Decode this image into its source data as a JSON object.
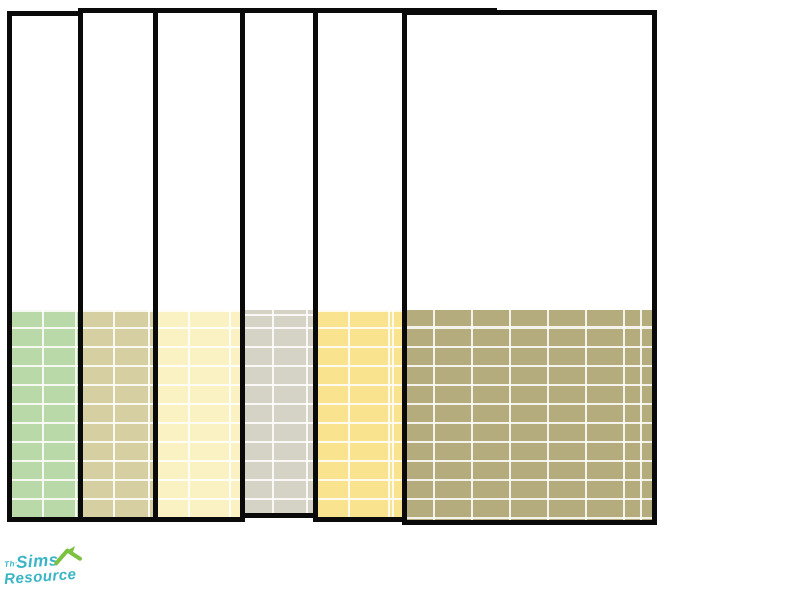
{
  "panels": {
    "border_color": "#0a0a0a",
    "wall_color": "#ffffff",
    "grout_color": "#f5f3e8",
    "items": [
      {
        "id": "swatch-1",
        "color_name": "pastel-green",
        "tile_color": "#b9daa8"
      },
      {
        "id": "swatch-2",
        "color_name": "tan",
        "tile_color": "#d6cfa1"
      },
      {
        "id": "swatch-3",
        "color_name": "cream",
        "tile_color": "#fbf2c4"
      },
      {
        "id": "swatch-4",
        "color_name": "warm-gray",
        "tile_color": "#d5d3c5"
      },
      {
        "id": "swatch-5",
        "color_name": "butter-yellow",
        "tile_color": "#f9e38e"
      },
      {
        "id": "swatch-6",
        "color_name": "olive",
        "tile_color": "#b4ac7c"
      }
    ]
  },
  "logo": {
    "the": "The",
    "sims": "Sims",
    "resource": "Resource",
    "text_color": "#3ab5c6",
    "roof_color": "#7dc142"
  }
}
